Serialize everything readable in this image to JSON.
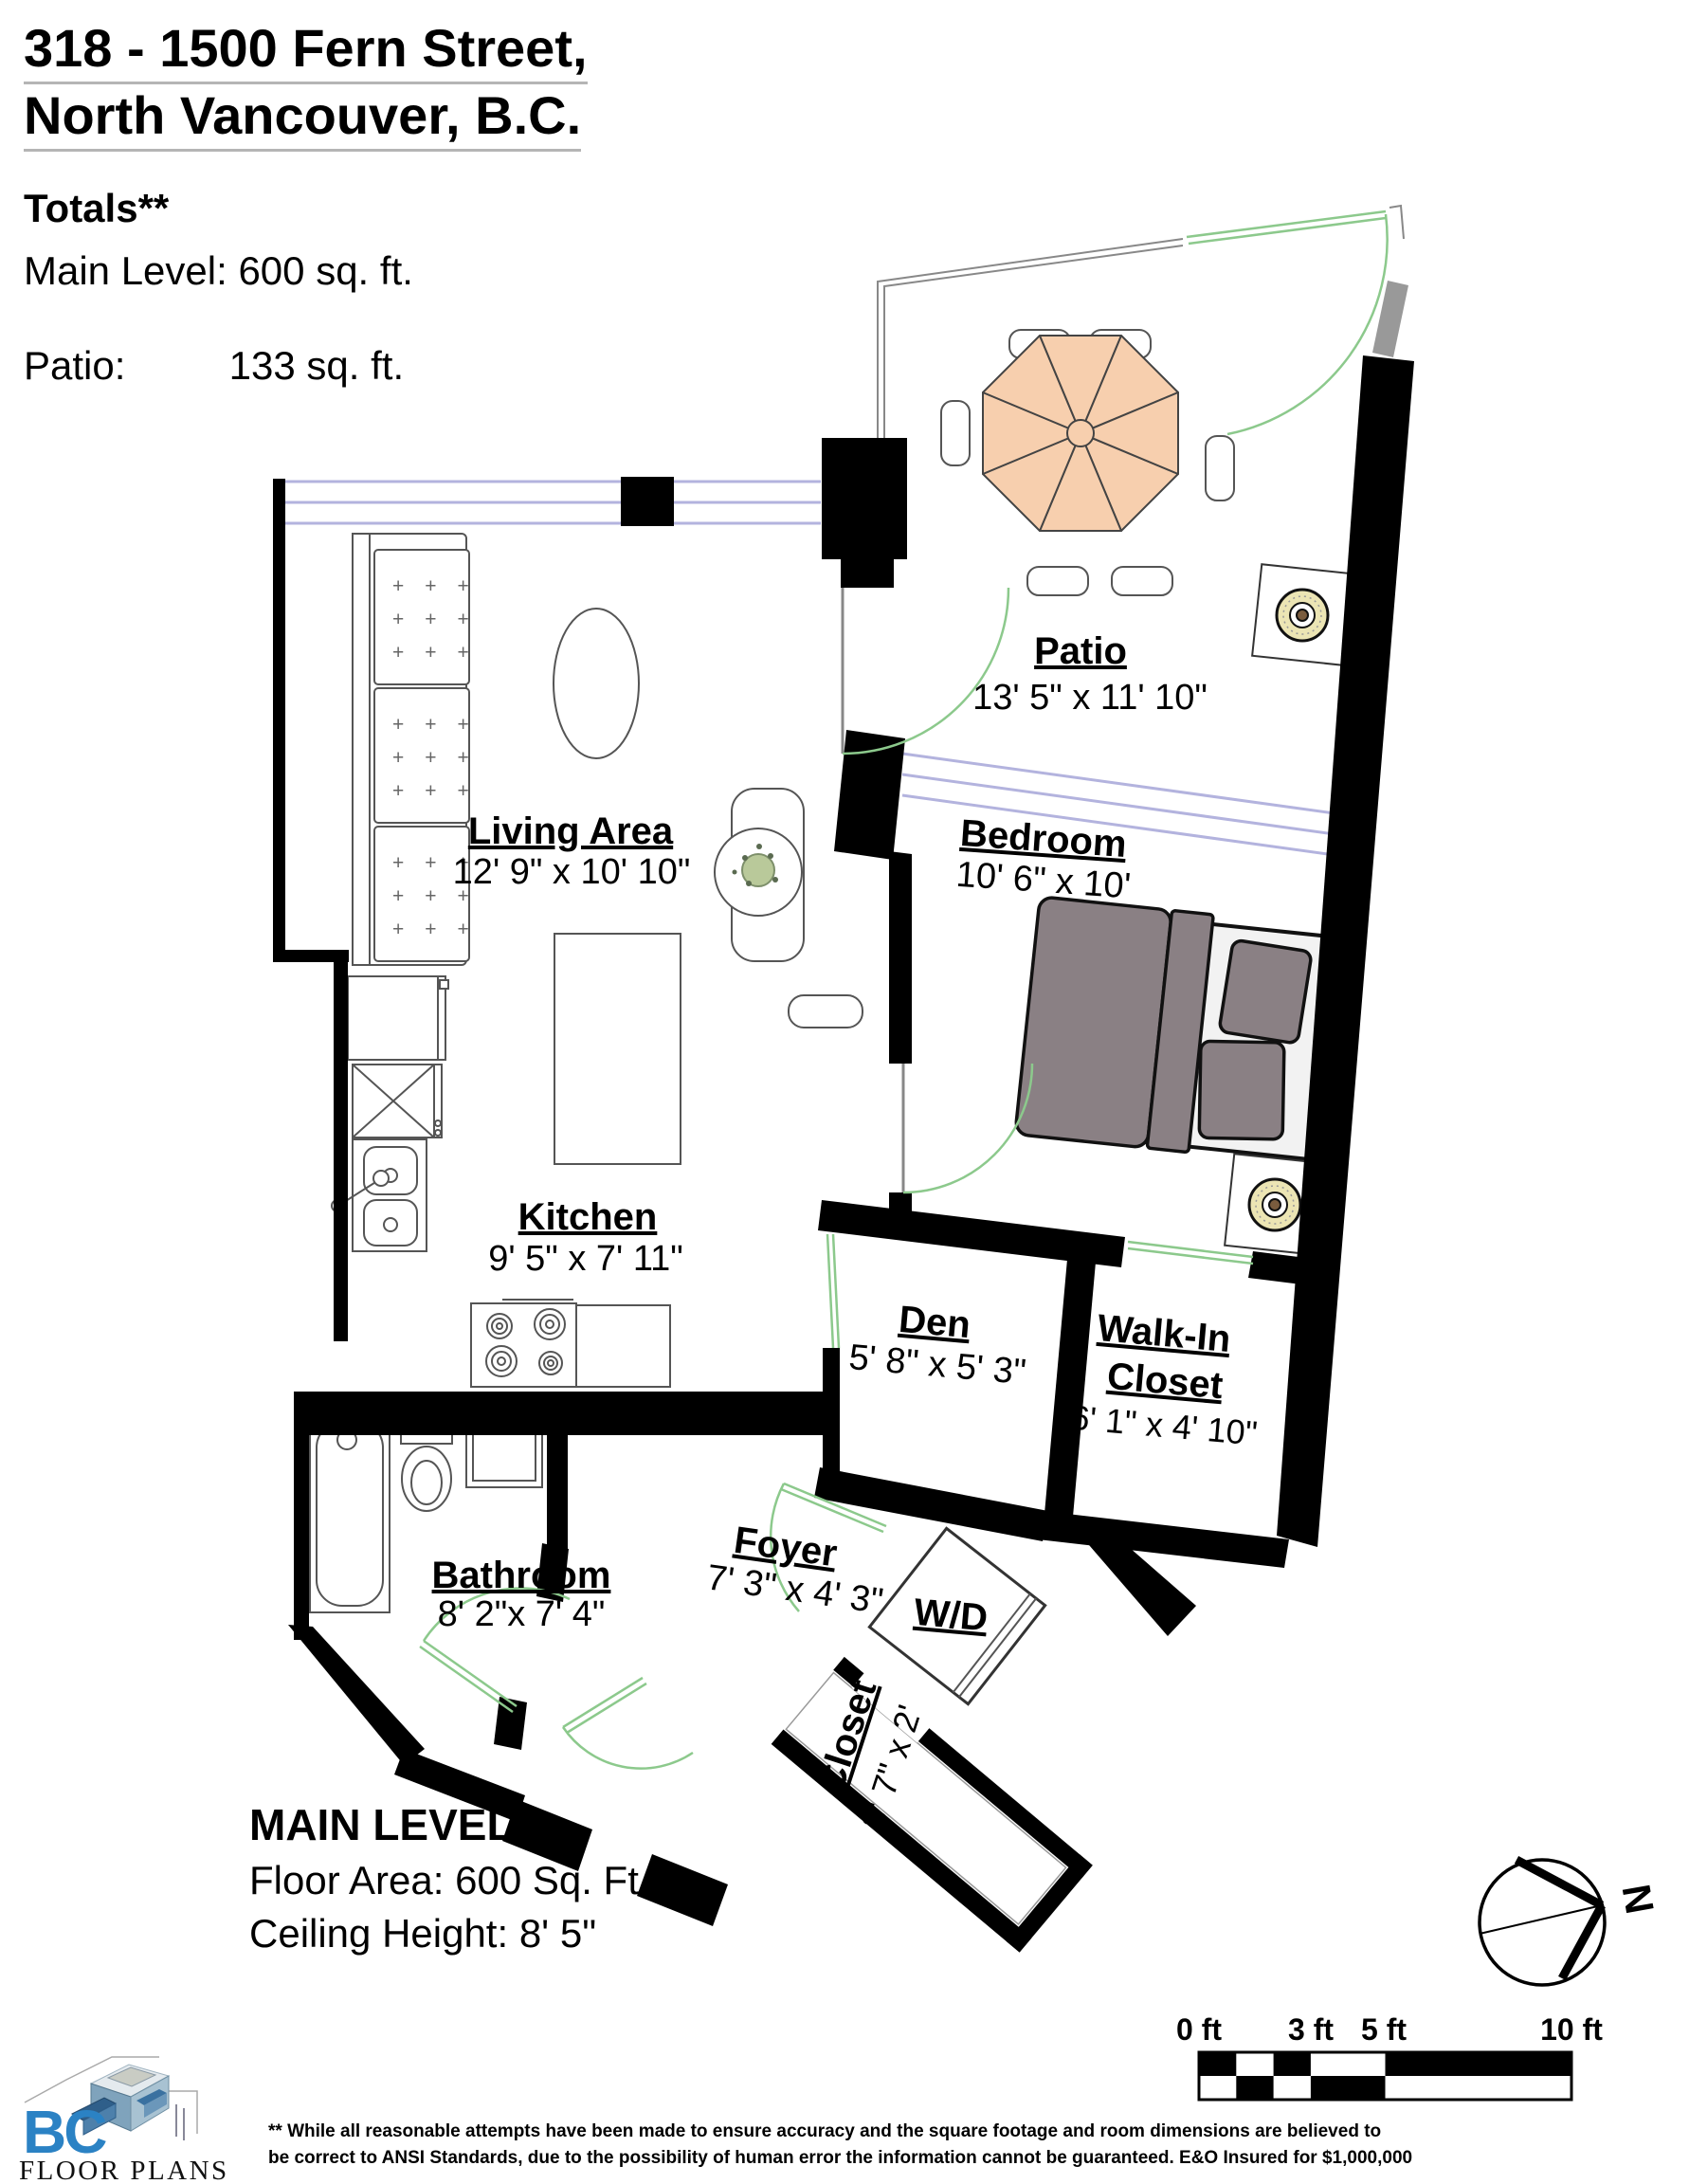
{
  "header": {
    "address_line1": "318 - 1500 Fern Street,",
    "address_line2": "North Vancouver, B.C.",
    "totals_heading": "Totals**",
    "totals": {
      "main_level_label": "Main Level:",
      "main_level_value": "600 sq. ft.",
      "patio_label": "Patio:",
      "patio_value": "133 sq. ft."
    }
  },
  "rooms": {
    "patio": {
      "name": "Patio",
      "dims": "13' 5\" x 11' 10\""
    },
    "living": {
      "name": "Living Area",
      "dims": "12' 9\" x 10' 10\""
    },
    "bedroom": {
      "name": "Bedroom",
      "dims": "10' 6\" x 10'"
    },
    "kitchen": {
      "name": "Kitchen",
      "dims": "9' 5\" x 7' 11\""
    },
    "den": {
      "name": "Den",
      "dims": "5' 8\" x 5' 3\""
    },
    "walk_in_closet": {
      "name_line1": "Walk-In",
      "name_line2": "Closet",
      "dims": "6' 1\" x 4' 10\""
    },
    "bathroom": {
      "name": "Bathroom",
      "dims": "8' 2\"x 7' 4\""
    },
    "foyer": {
      "name": "Foyer",
      "dims": "7' 3\" x 4' 3\""
    },
    "wd": {
      "name": "W/D"
    },
    "closet": {
      "name": "Closet",
      "dims": "3' 7\" x 2'"
    }
  },
  "level_summary": {
    "title": "MAIN LEVEL",
    "floor_area": "Floor Area: 600 Sq. Ft.",
    "ceiling_height": "Ceiling Height: 8' 5\""
  },
  "scale_bar": {
    "labels": [
      "0 ft",
      "3 ft",
      "5 ft",
      "10 ft"
    ]
  },
  "compass": {
    "north_label": "N"
  },
  "logo": {
    "bc": "BC",
    "floor_plans": "FLOOR PLANS"
  },
  "disclaimer": {
    "line1": "** While all reasonable attempts have been made to ensure accuracy and the square footage and room dimensions are believed to",
    "line2": "be correct to ANSI Standards, due to the possibility of human error the information cannot be guaranteed. E&O Insured for $1,000,000"
  },
  "colors": {
    "wall": "#000000",
    "window": "#b3b3de",
    "door": "#8cc98c",
    "gray_wall": "#999999",
    "umbrella": "#f7cfae",
    "bed": "#8a8084",
    "headboard": "#9c8a74",
    "lamp": "#ece5b4",
    "logo_blue": "#2b82c4"
  }
}
